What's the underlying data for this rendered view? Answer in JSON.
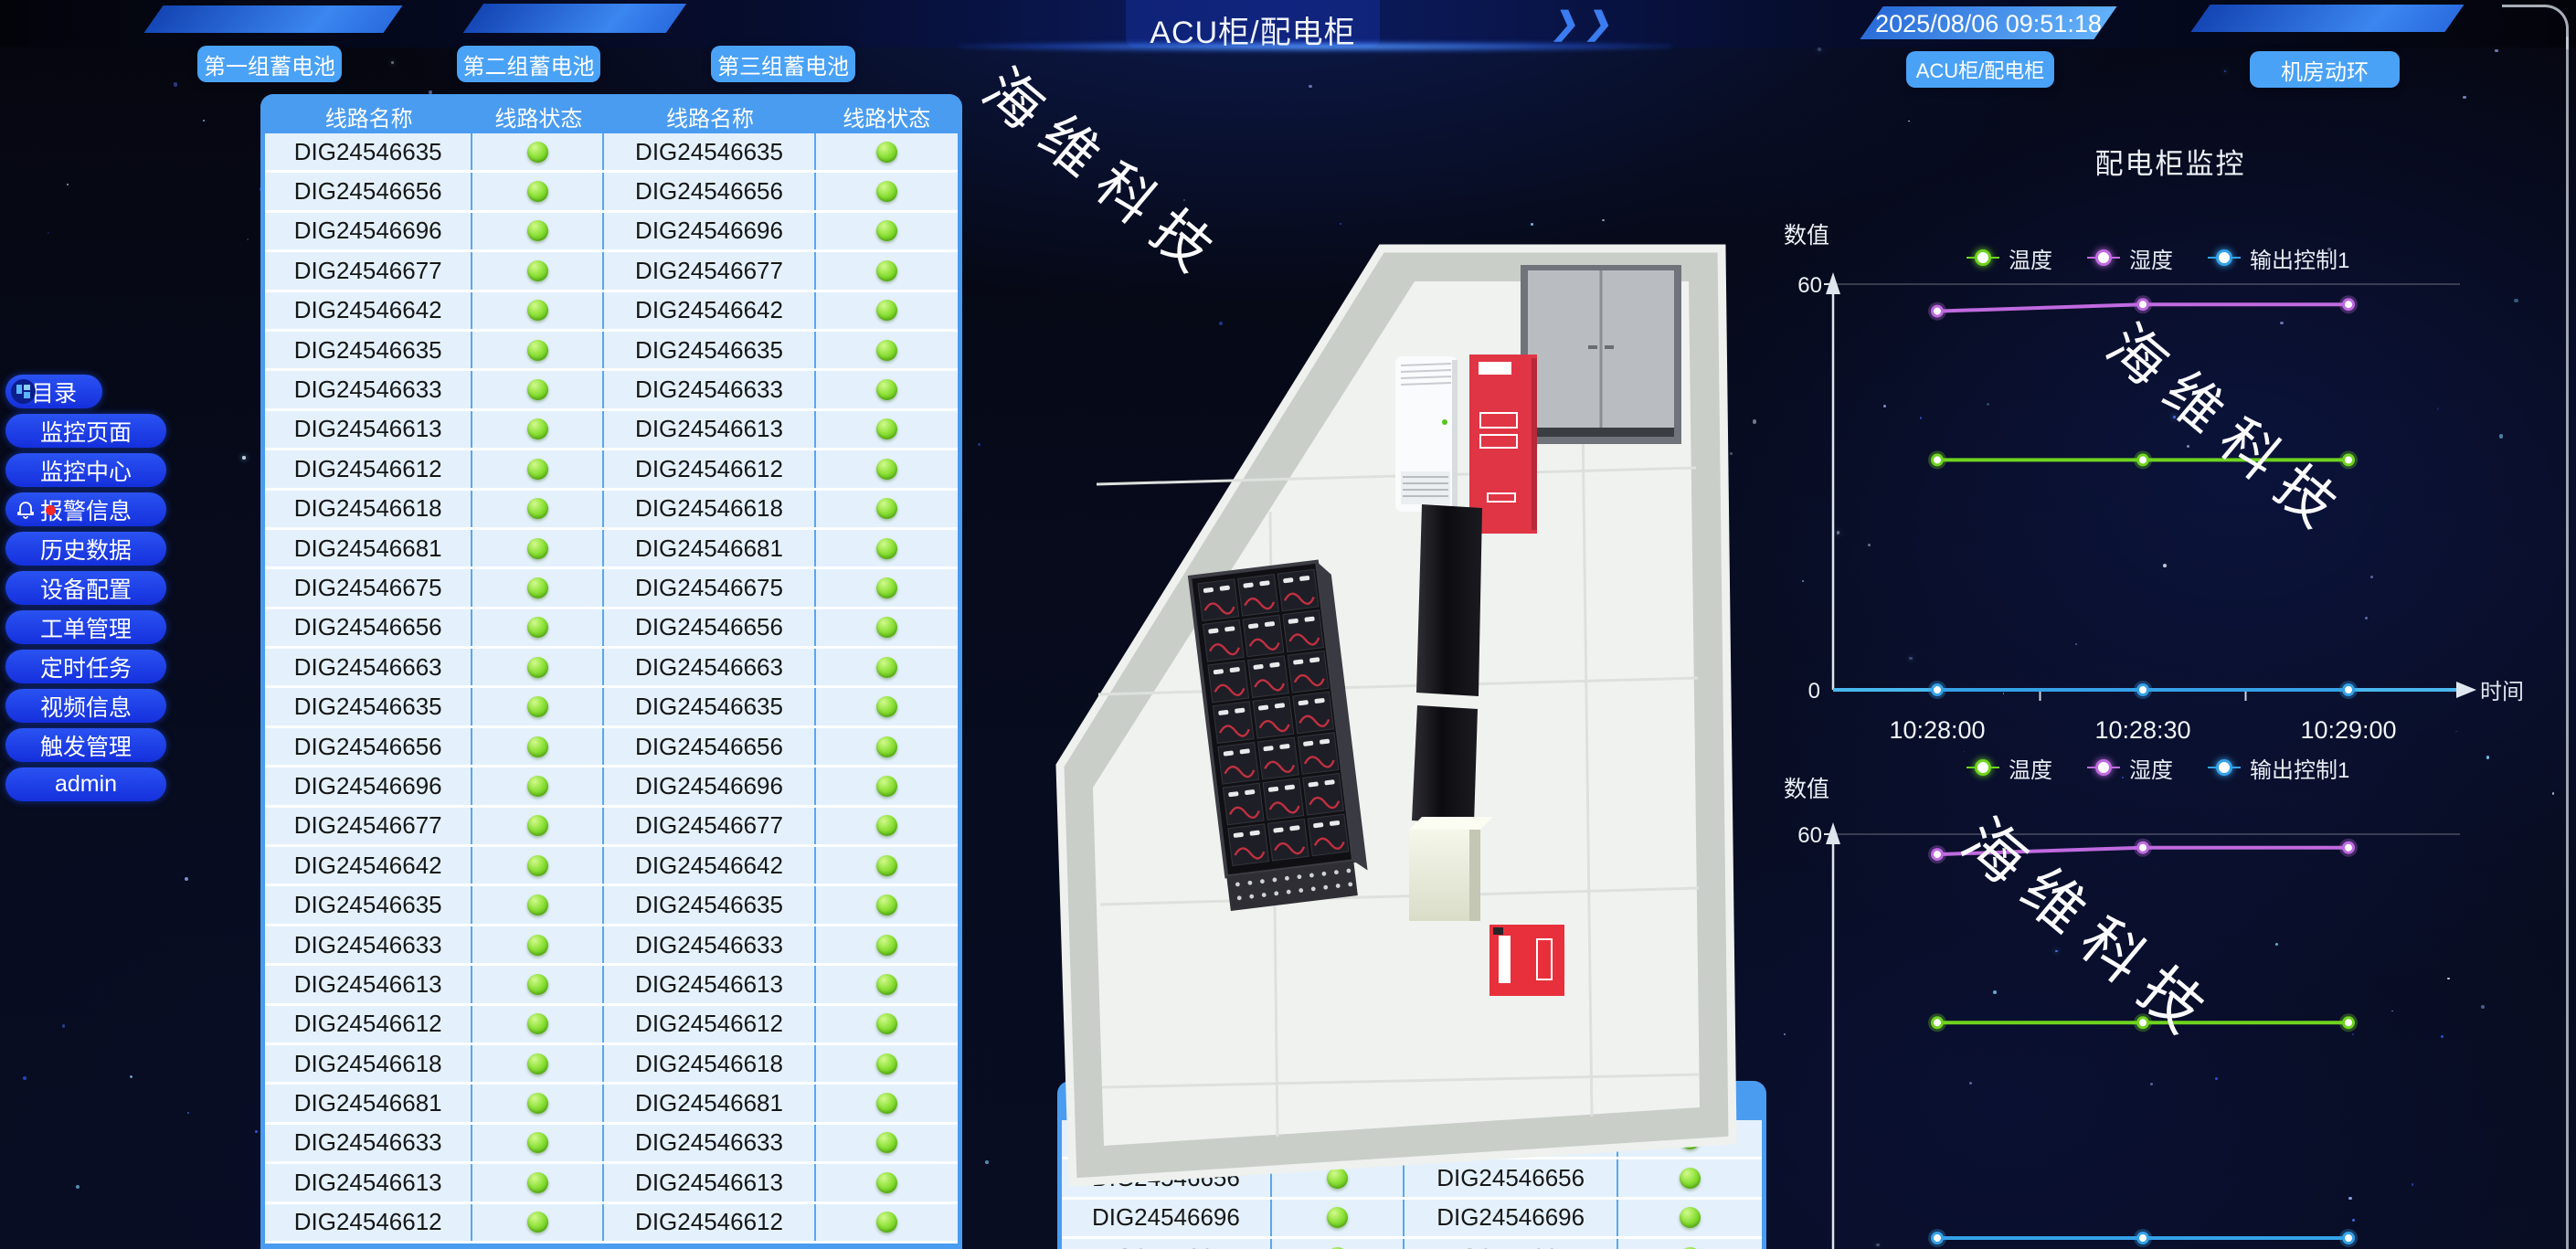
{
  "header": {
    "title": "ACU柜/配电柜",
    "timestamp": "2025/08/06 09:51:18",
    "decor_chevrons": "❯❯"
  },
  "nav": {
    "battery_buttons": [
      "第一组蓄电池",
      "第二组蓄电池",
      "第三组蓄电池"
    ],
    "page_buttons": [
      "ACU柜/配电柜",
      "机房动环"
    ]
  },
  "sidebar": {
    "items": [
      {
        "label": "目录",
        "icon": "menu-grid-icon"
      },
      {
        "label": "监控页面"
      },
      {
        "label": "监控中心"
      },
      {
        "label": "报警信息",
        "icon": "bell-icon",
        "badge": true
      },
      {
        "label": "历史数据"
      },
      {
        "label": "设备配置"
      },
      {
        "label": "工单管理"
      },
      {
        "label": "定时任务"
      },
      {
        "label": "视频信息"
      },
      {
        "label": "触发管理"
      },
      {
        "label": "admin"
      }
    ]
  },
  "circuit_table": {
    "headers": [
      "线路名称",
      "线路状态",
      "线路名称",
      "线路状态"
    ],
    "rows": [
      "DIG24546635",
      "DIG24546656",
      "DIG24546696",
      "DIG24546677",
      "DIG24546642",
      "DIG24546635",
      "DIG24546633",
      "DIG24546613",
      "DIG24546612",
      "DIG24546618",
      "DIG24546681",
      "DIG24546675",
      "DIG24546656",
      "DIG24546663",
      "DIG24546635",
      "DIG24546656",
      "DIG24546696",
      "DIG24546677",
      "DIG24546642",
      "DIG24546635",
      "DIG24546633",
      "DIG24546613",
      "DIG24546612",
      "DIG24546618",
      "DIG24546681",
      "DIG24546633",
      "DIG24546613",
      "DIG24546612"
    ],
    "status_all": "green"
  },
  "bottom_table": {
    "headers": [
      "线路名称",
      "线路状态",
      "线路名称",
      "线路状态"
    ],
    "rows": [
      "DIG24546635",
      "DIG24546656",
      "DIG24546696",
      "DIG24546677"
    ],
    "status_all": "green"
  },
  "watermark": "海维科技",
  "charts": {
    "section_title": "配电柜监控",
    "y_axis_label": "数值",
    "x_axis_label": "时间",
    "y_tick_top": "60",
    "y_tick_zero": "0"
  },
  "chart_data": [
    {
      "type": "line",
      "title": "配电柜监控",
      "x": [
        "10:28:00",
        "10:28:30",
        "10:29:00"
      ],
      "series": [
        {
          "name": "温度",
          "color": "#6fd41f",
          "values": [
            34,
            34,
            34
          ]
        },
        {
          "name": "湿度",
          "color": "#c06ae0",
          "values": [
            56,
            57,
            57
          ]
        },
        {
          "name": "输出控制1",
          "color": "#35a2e8",
          "values": [
            0,
            0,
            0
          ]
        }
      ],
      "ylabel": "数值",
      "xlabel": "时间",
      "ylim": [
        0,
        60
      ],
      "yticks": [
        0,
        60
      ],
      "x_axis_visible": true,
      "legend_position": "top"
    },
    {
      "type": "line",
      "x": [
        "10:28:00",
        "10:28:30",
        "10:29:00"
      ],
      "series": [
        {
          "name": "温度",
          "color": "#6fd41f",
          "values": [
            32,
            32,
            32
          ]
        },
        {
          "name": "湿度",
          "color": "#c06ae0",
          "values": [
            57,
            58,
            58
          ]
        },
        {
          "name": "输出控制1",
          "color": "#35a2e8",
          "values": [
            0,
            0,
            0
          ]
        }
      ],
      "ylabel": "数值",
      "ylim": [
        0,
        60
      ],
      "yticks": [
        60
      ],
      "x_axis_visible": false,
      "legend_position": "top"
    }
  ],
  "colors": {
    "accent_blue": "#4a9cf0",
    "button_blue": "#4aa2f6",
    "sidebar_blue": "#1d3ae8",
    "status_green": "#7ed62a",
    "axis_cyan": "#49b8f0",
    "alert_red": "#e8303c",
    "temp_green": "#6fd41f",
    "humidity_purple": "#c06ae0",
    "output_blue": "#35a2e8"
  }
}
